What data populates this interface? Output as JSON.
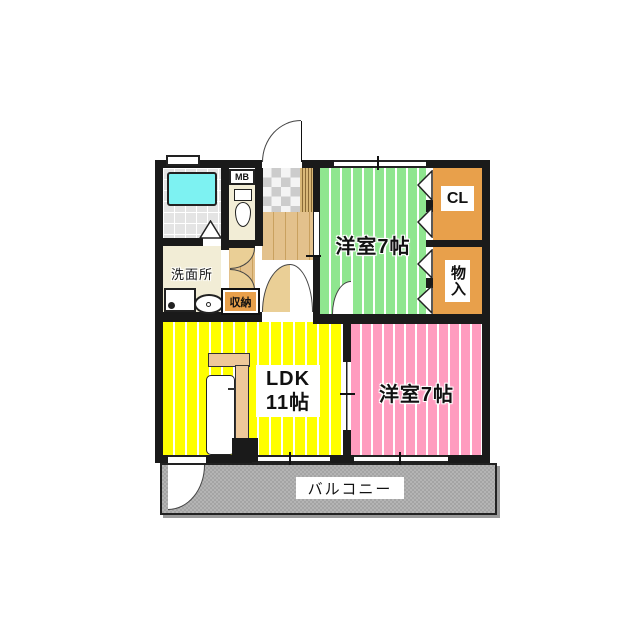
{
  "rooms": {
    "bedroom_green": {
      "label": "洋室7帖",
      "fill": "#8fe68f"
    },
    "bedroom_pink": {
      "label": "洋室7帖",
      "fill": "#ff9cbf"
    },
    "ldk": {
      "label_line1": "LDK",
      "label_line2": "11帖",
      "fill": "#ffff00"
    },
    "washroom": {
      "label": "洗面所",
      "fill": "#f2edd6"
    },
    "balcony": {
      "label": "バルコニー",
      "fill": "#ababab"
    },
    "closet_cl": {
      "label": "CL",
      "fill": "#e8a04b"
    },
    "closet_monoire": {
      "label": "物入",
      "fill": "#e8a04b"
    },
    "storage_shuno": {
      "label": "収納",
      "fill": "#e8a04b"
    },
    "meter_box": {
      "label": "MB"
    }
  },
  "fixtures": {
    "bathtub_color": "#7df2f2",
    "wall_color": "#1a1a1a",
    "flooring_color": "#e3c18c",
    "balcony_color": "#ababab"
  }
}
